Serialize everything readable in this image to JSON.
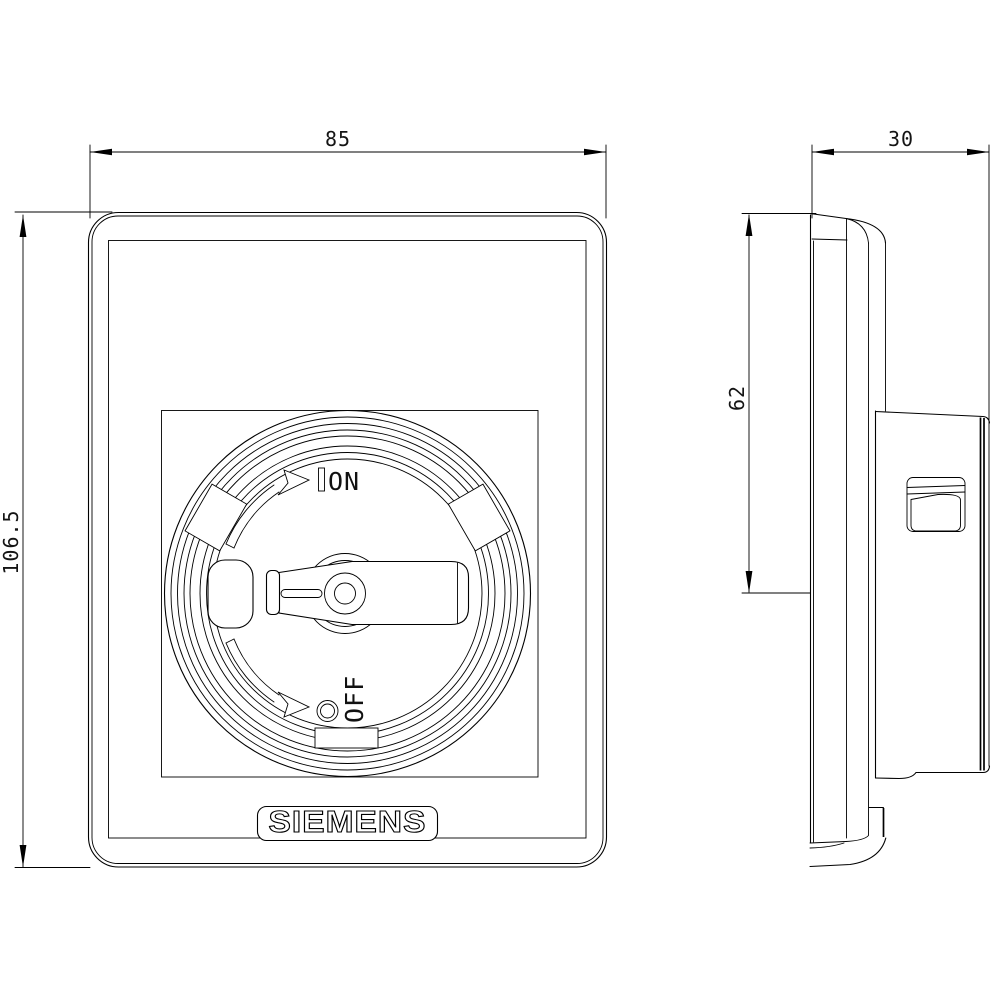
{
  "drawing": {
    "background": "#ffffff",
    "line_color": "#000000",
    "brand_label": "SIEMENS",
    "dimensions": {
      "front_width": "85",
      "front_height": "106.5",
      "side_depth": "30",
      "side_handle_height": "62"
    },
    "switch_labels": {
      "on": "ON",
      "off": "OFF"
    }
  }
}
